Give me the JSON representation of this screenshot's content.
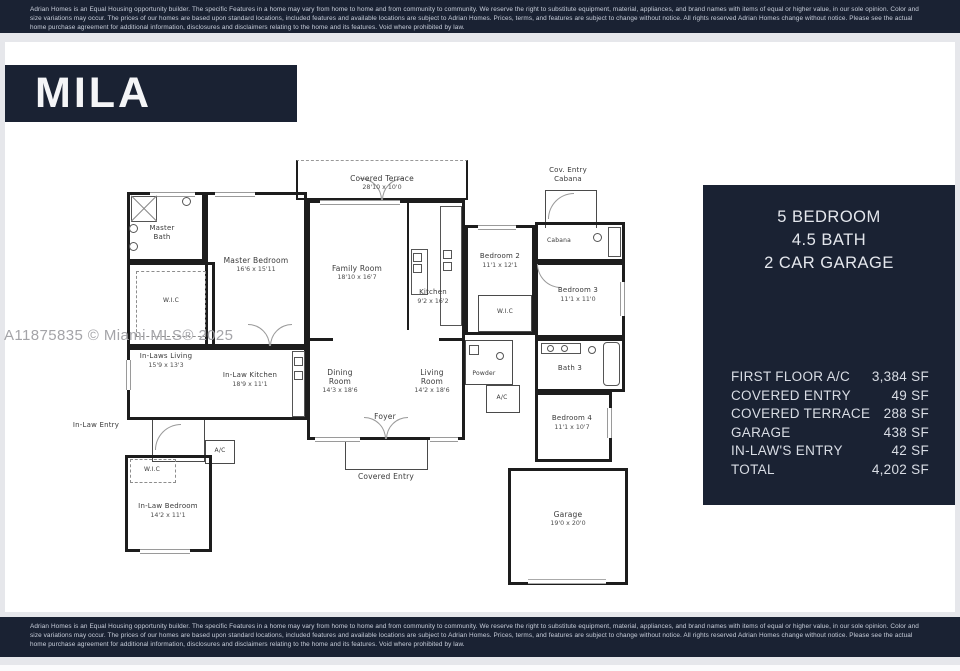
{
  "disclaimer": {
    "line": "Adrian Homes is an Equal Housing opportunity builder. The specific Features in a home may vary from home to home and from community to community. We reserve the right to substitute equipment, material, appliances, and brand names with items of equal or higher value, in our sole opinion. Color and size variations may occur. The prices of our homes are based upon standard locations, included features and available locations are subject to Adrian Homes. Prices, terms, and features are subject to change without notice. All rights reserved Adrian Homes change without notice. Please see the actual home purchase agreement for additional information, disclosures and disclaimers relating to the home and its features. Void where prohibited by law."
  },
  "plan_name": "MILA",
  "watermark": "A11875835 © Miami MLS® 2025",
  "summary": {
    "headline": [
      "5 BEDROOM",
      "4.5 BATH",
      "2 CAR GARAGE"
    ],
    "areas": [
      {
        "label": "FIRST FLOOR A/C",
        "value": "3,384 SF"
      },
      {
        "label": "COVERED ENTRY",
        "value": "49 SF"
      },
      {
        "label": "COVERED TERRACE",
        "value": "288 SF"
      },
      {
        "label": "GARAGE",
        "value": "438 SF"
      },
      {
        "label": "IN-LAW'S ENTRY",
        "value": "42 SF"
      },
      {
        "label": "TOTAL",
        "value": "4,202 SF"
      }
    ]
  },
  "rooms": {
    "covered_terrace": {
      "name": "Covered Terrace",
      "dims": "28'10 x 10'0"
    },
    "master_bath": {
      "name": "Master Bath"
    },
    "master_wic": {
      "name": "W.I.C"
    },
    "master_bedroom": {
      "name": "Master Bedroom",
      "dims": "16'6 x 15'11"
    },
    "family_room": {
      "name": "Family Room",
      "dims": "18'10 x 16'7"
    },
    "kitchen": {
      "name": "Kitchen",
      "dims": "9'2 x 16'2"
    },
    "bedroom2": {
      "name": "Bedroom 2",
      "dims": "11'1 x 12'1"
    },
    "bedroom2_wic": {
      "name": "W.I.C"
    },
    "cov_entry_cabana": {
      "name": "Cov. Entry",
      "name2": "Cabana"
    },
    "cabana": {
      "name": "Cabana"
    },
    "bedroom3": {
      "name": "Bedroom 3",
      "dims": "11'1 x 11'0"
    },
    "bath3": {
      "name": "Bath 3"
    },
    "in_laws_living": {
      "name": "In-Laws Living",
      "dims": "15'9 x 13'3"
    },
    "in_law_kitchen": {
      "name": "In-Law Kitchen",
      "dims": "18'9 x 11'1"
    },
    "dining_room": {
      "name": "Dining Room",
      "dims": "14'3 x 18'6"
    },
    "living_room": {
      "name": "Living Room",
      "dims": "14'2 x 18'6"
    },
    "foyer": {
      "name": "Foyer"
    },
    "powder": {
      "name": "Powder"
    },
    "ac_main": {
      "name": "A/C"
    },
    "ac_inlaw": {
      "name": "A/C"
    },
    "in_law_entry": {
      "name": "In-Law Entry"
    },
    "in_law_wic": {
      "name": "W.I.C"
    },
    "in_law_bedroom": {
      "name": "In-Law Bedroom",
      "dims": "14'2 x 11'1"
    },
    "bedroom4": {
      "name": "Bedroom 4",
      "dims": "11'1 x 10'7"
    },
    "covered_entry": {
      "name": "Covered Entry"
    },
    "garage": {
      "name": "Garage",
      "dims": "19'0 x 20'0"
    }
  },
  "colors": {
    "navy": "#1a2233",
    "wall": "#1d1d1d",
    "watermark": "#a4a4a8"
  }
}
